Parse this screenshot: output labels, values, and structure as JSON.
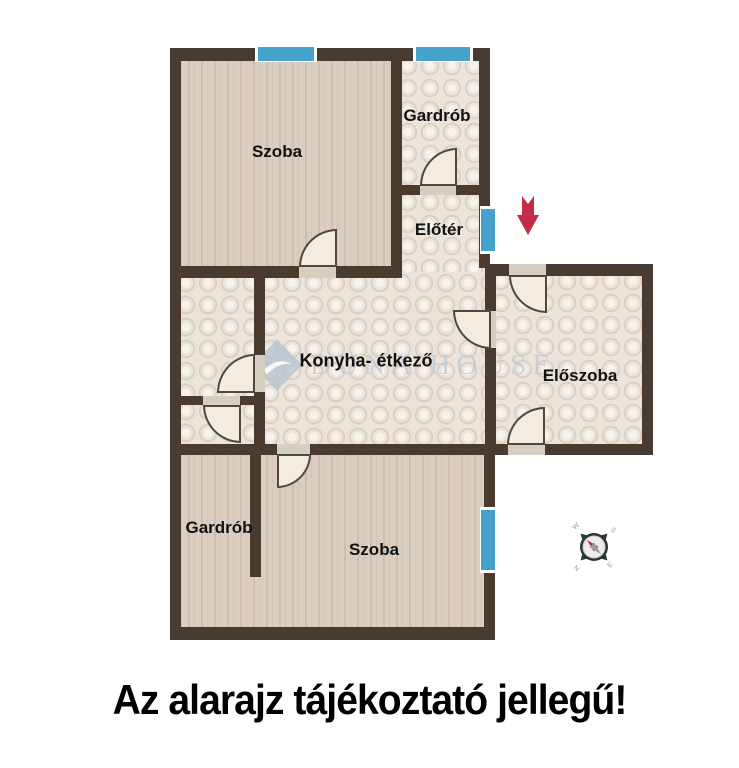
{
  "rooms": {
    "szoba_top": "Szoba",
    "gardrob_top": "Gardrób",
    "eloter": "Előtér",
    "konyha": "Konyha- étkező",
    "eloszoba": "Előszoba",
    "gardrob_bottom": "Gardrób",
    "szoba_bottom": "Szoba"
  },
  "watermark": {
    "display": "DUNA HOUSE",
    "reg": "®"
  },
  "compass": {
    "nw": "W",
    "ne": "S",
    "sw": "N",
    "se": "E"
  },
  "caption": "Az alarajz tájékoztató jellegű!",
  "colors": {
    "wall": "#4a3b31",
    "window_blue": "#45a2cb",
    "wood_floor": "#dbcec0",
    "tile_floor": "#ece3da",
    "entrance_arrow": "#c32b4a",
    "watermark": "#bfcad5"
  }
}
